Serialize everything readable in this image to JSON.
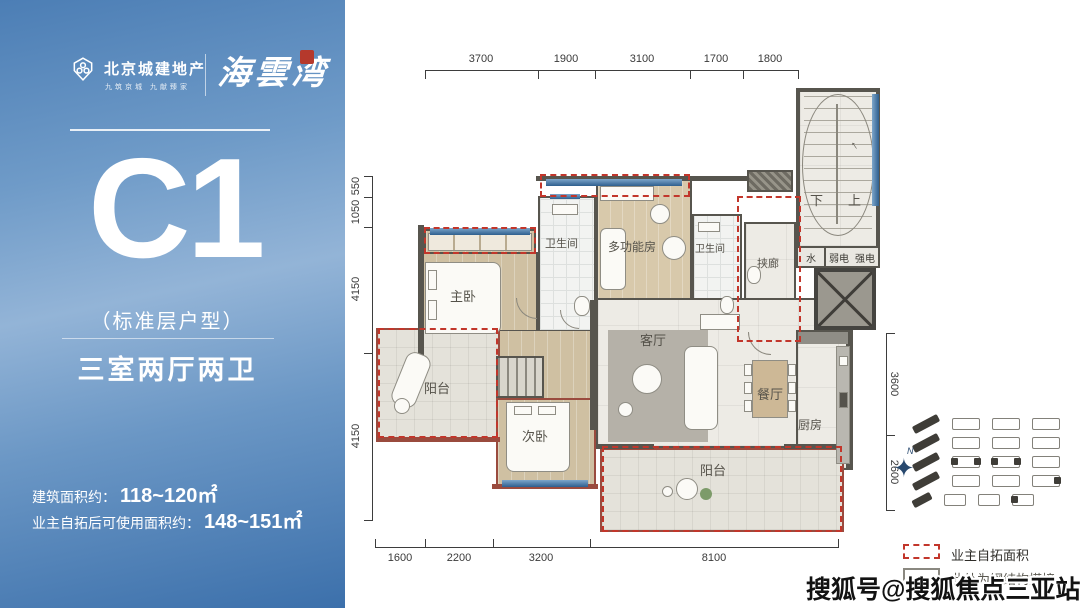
{
  "brand": {
    "company": "北京城建地产",
    "slogan": "九筑京城 九献臻家",
    "project": "海雲湾"
  },
  "unit": {
    "code": "C1",
    "type_note": "（标准层户型）",
    "layout": "三室两厅两卫"
  },
  "areas": [
    {
      "label": "建筑面积约：",
      "value": "118~120㎡"
    },
    {
      "label": "业主自拓后可使用面积约：",
      "value": "148~151㎡"
    }
  ],
  "dimensions": {
    "top": [
      "3700",
      "1900",
      "3100",
      "1700",
      "1800"
    ],
    "left": [
      "550",
      "1050",
      "4150",
      "4150"
    ],
    "bottom": [
      "1600",
      "2200",
      "3200",
      "8100"
    ],
    "right": [
      "3600",
      "2600"
    ]
  },
  "plan": {
    "rooms": {
      "master_bedroom": "主卧",
      "bath1": "卫生间",
      "multi_room": "多功能房",
      "bath2": "卫生间",
      "corridor": "挟廊",
      "living": "客厅",
      "dining": "餐厅",
      "kitchen": "厨房",
      "balcony_left": "阳台",
      "balcony_bottom": "阳台",
      "second_bedroom": "次卧",
      "water": "水",
      "weak_power": "弱电",
      "strong_power": "强电",
      "stair_down": "下",
      "stair_up": "上"
    },
    "compass_label": "N"
  },
  "legend": [
    {
      "style": "red-dashed",
      "label": "业主自拓面积"
    },
    {
      "style": "solid",
      "label": "此处为钢结构搭接"
    }
  ],
  "watermark": "搜狐号@搜狐焦点三亚站",
  "colors": {
    "accent_red": "#c2362b",
    "window_blue": "#3f6f9e",
    "panel_blue_top": "#4c7eb5",
    "panel_blue_bottom": "#3c70ab",
    "wall_gray": "#57554e",
    "wall_red_brown": "#9a4b3e"
  }
}
